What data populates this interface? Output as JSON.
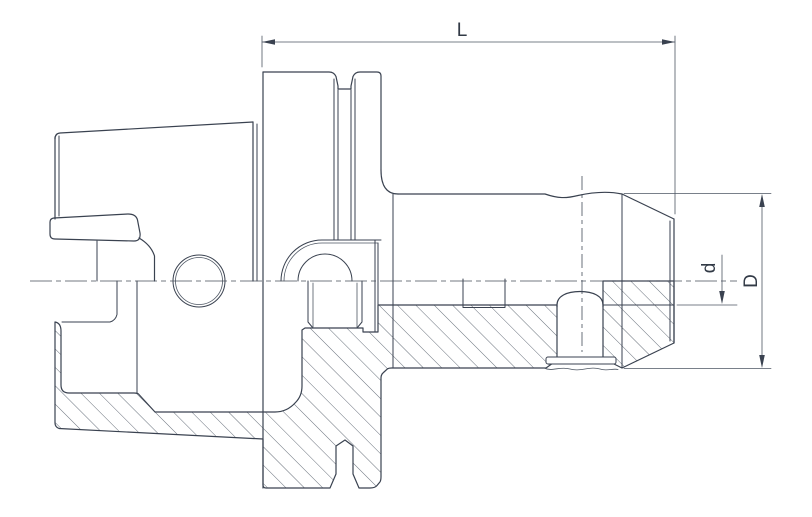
{
  "drawing": {
    "type": "technical-section-drawing",
    "subject": "tool-holder-cross-section",
    "view": "side view, lower half in section with 45-degree hatching",
    "labels": {
      "length": "L",
      "bore_diameter": "d",
      "body_diameter": "D"
    },
    "colors": {
      "background": "#ffffff",
      "line": "#3a4250",
      "thin_line": "#4d5663",
      "hatch": "#4d5663",
      "text": "#323a46"
    }
  }
}
